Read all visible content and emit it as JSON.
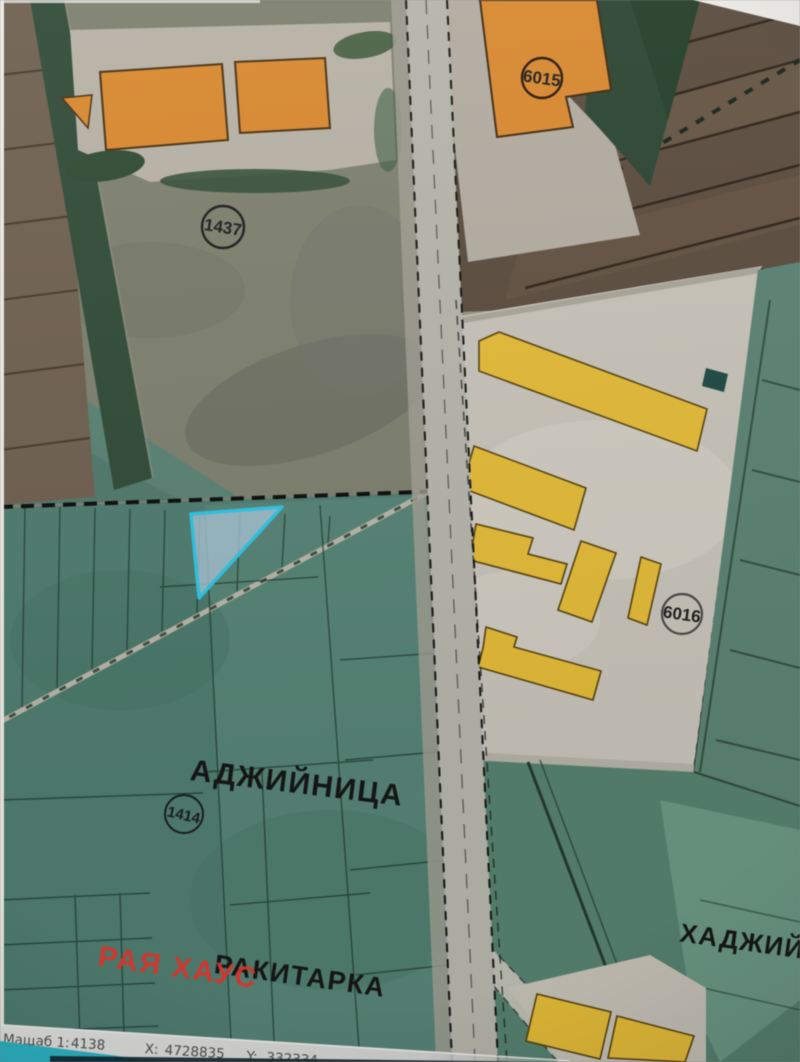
{
  "app": {
    "kind": "cadastral-map-viewer"
  },
  "map": {
    "parcel_numbers": [
      {
        "value": "1437"
      },
      {
        "value": "6015"
      },
      {
        "value": "6016"
      },
      {
        "value": "1414"
      }
    ],
    "locality_labels": [
      {
        "text": "АДЖИЙНИЦА"
      },
      {
        "text": "РАКИТАРКА"
      },
      {
        "text": "ХАДЖИЙ"
      }
    ],
    "watermark": {
      "text": "РАЯ ХАУС",
      "color": "#e4372e"
    },
    "selected_parcel": {
      "highlight_color": "#2fc4e4"
    },
    "legend_colors": {
      "building_orange": "#d8882f",
      "building_yellow": "#e2ba37",
      "farmland_teal": "#4f7c6f",
      "field_brown": "#5a4b3d",
      "road_grey": "#b4b4aa"
    }
  },
  "status_bar": {
    "scale_label": "Мащаб 1:",
    "scale_value": "4138",
    "x_label": "X:",
    "x_value": "4728835",
    "y_label": "Y:",
    "y_value": "332334"
  }
}
